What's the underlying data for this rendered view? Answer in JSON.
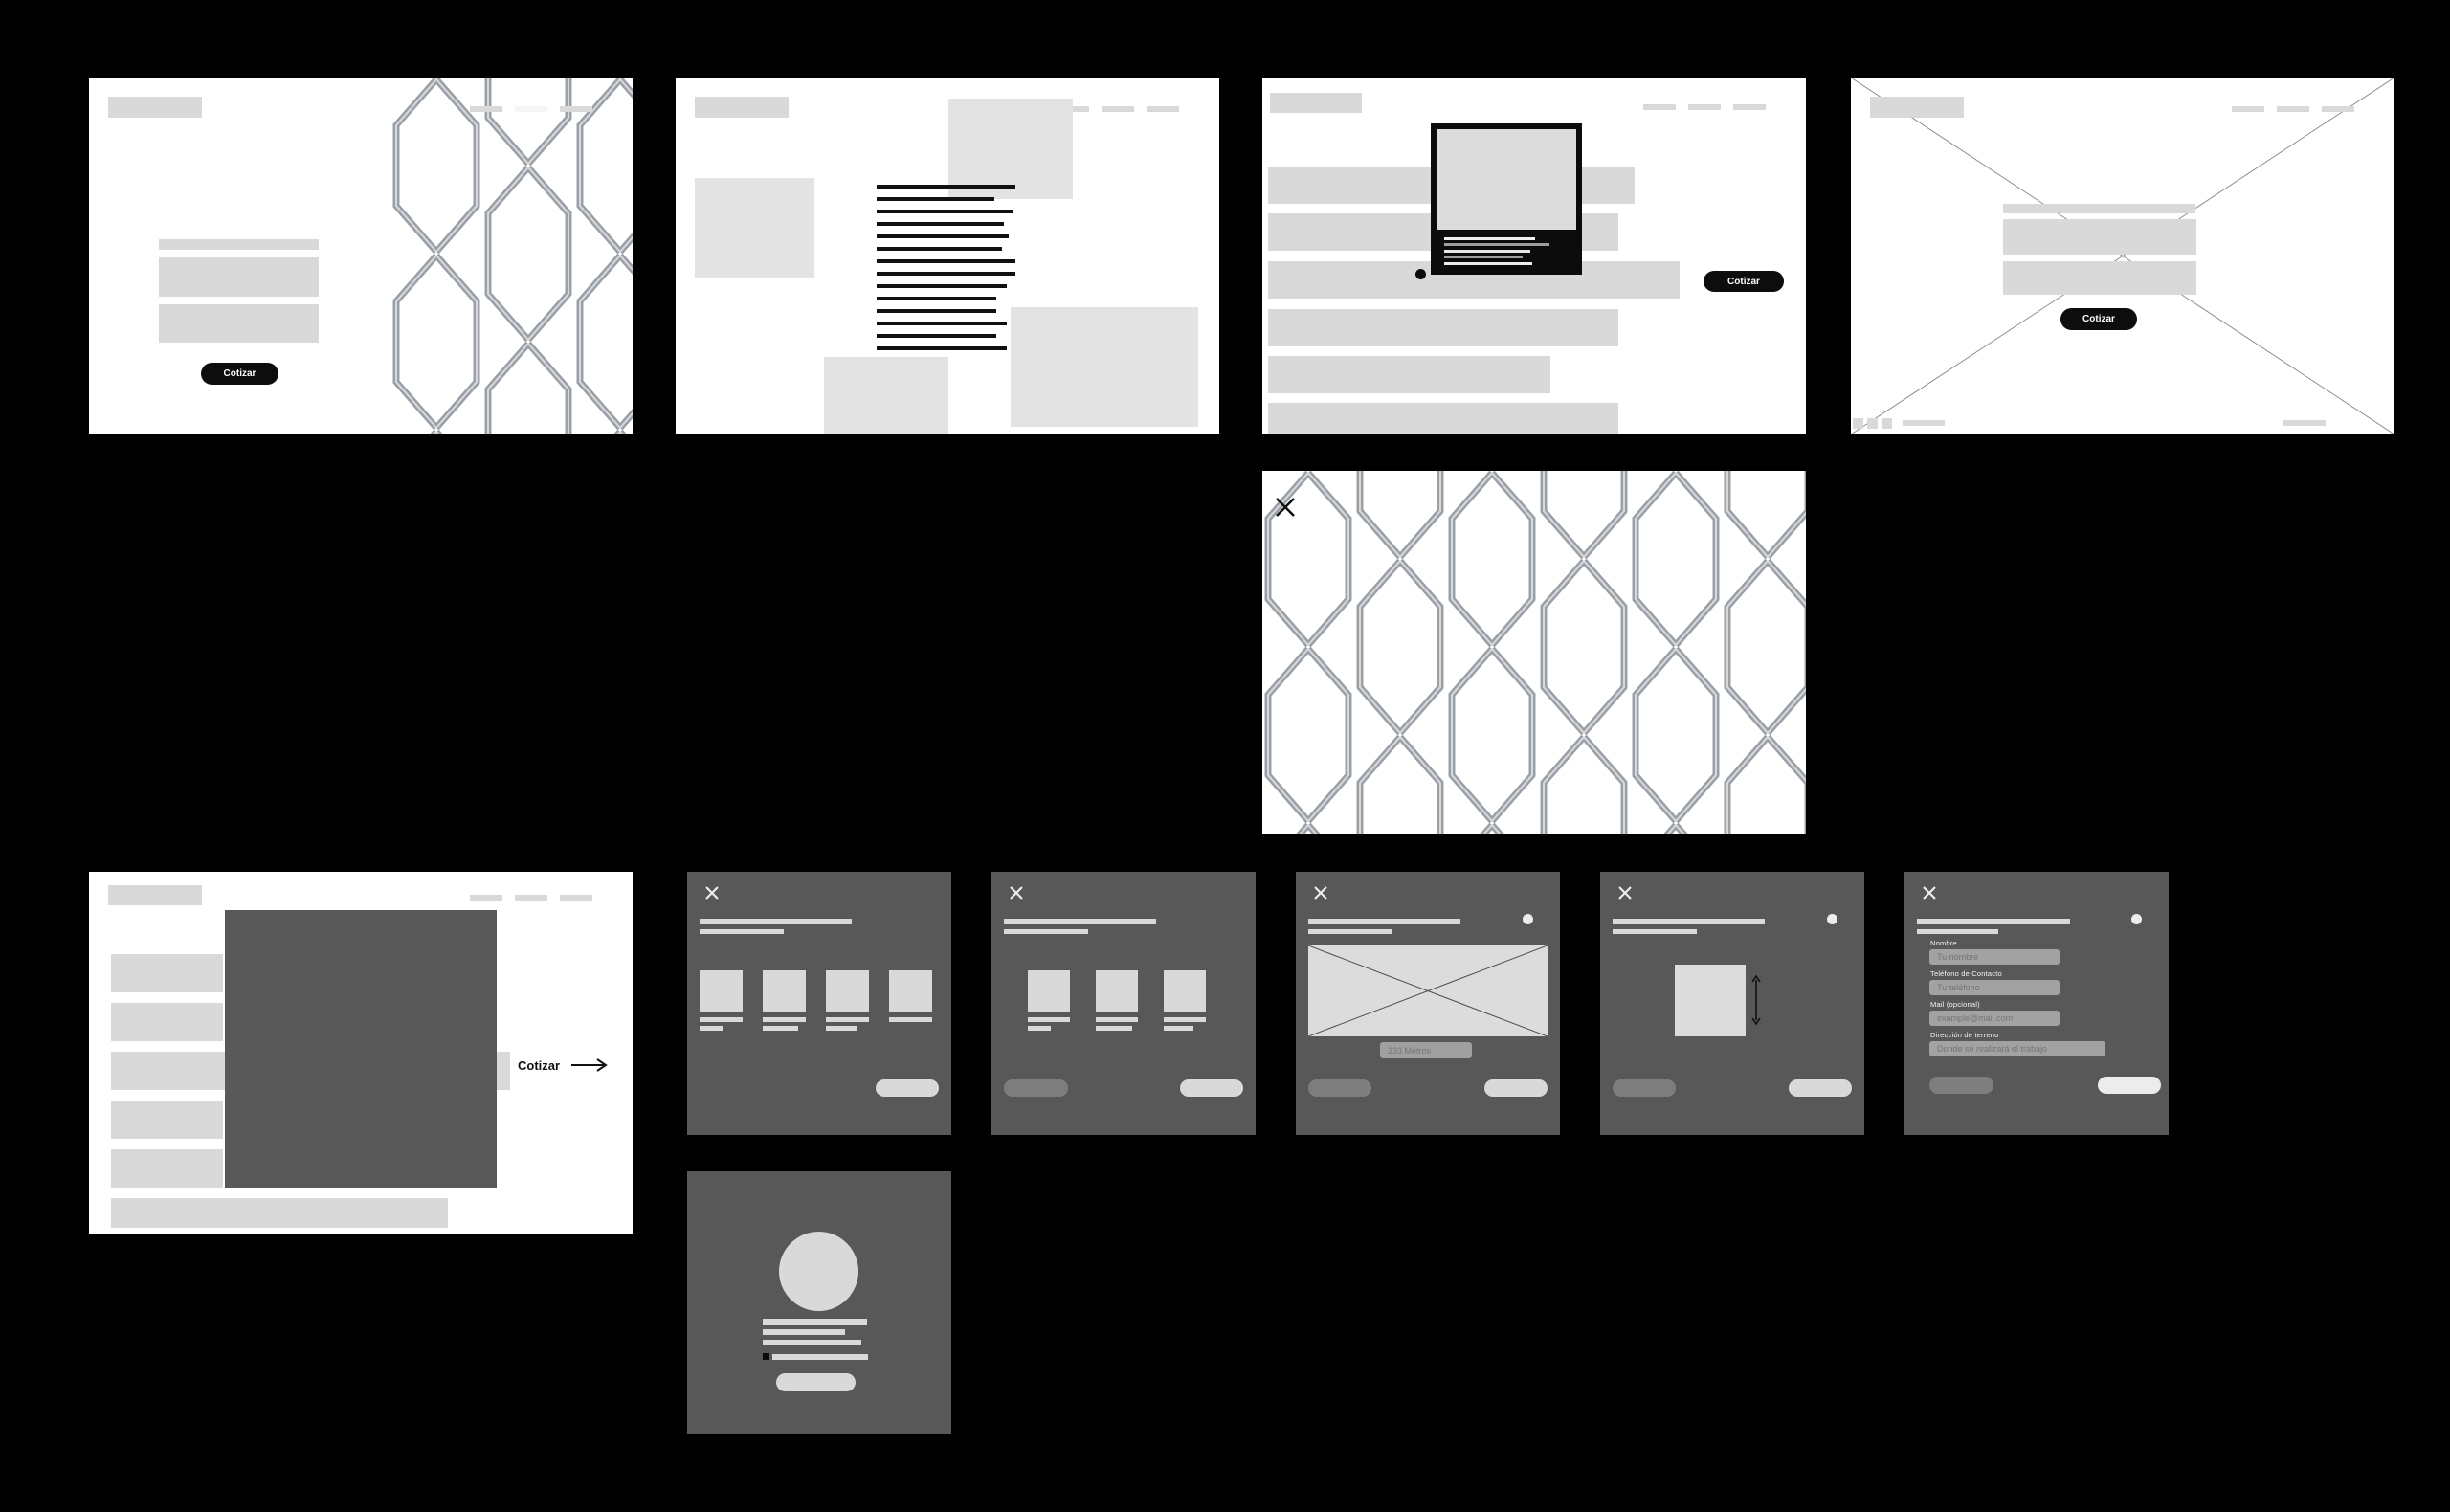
{
  "board": {
    "background": "#000000",
    "frame_bg": "#ffffff",
    "modal_bg": "#585858",
    "accent_black": "#0d0d0d",
    "placeholder_gray": "#d9d9d9"
  },
  "frames": {
    "hero": {
      "cta": "Cotizar"
    },
    "content": {},
    "product": {
      "cta": "Cotizar"
    },
    "placeholder": {
      "cta": "Cotizar"
    },
    "lightbox": {},
    "detail": {
      "cta_label": "Cotizar"
    }
  },
  "modals": {
    "options_four": {},
    "options_three": {},
    "measure": {
      "input_value": "333 Metros"
    },
    "height": {},
    "form": {
      "fields": [
        {
          "label": "Nombre",
          "placeholder": "Tu nombre"
        },
        {
          "label": "Teléfono de Contacto",
          "placeholder": "Tu teléfono"
        },
        {
          "label": "Mail (opcional)",
          "placeholder": "example@mail.com"
        },
        {
          "label": "Dirección de terreno",
          "placeholder": "Donde se realizará el trabajo"
        }
      ]
    },
    "confirmation": {}
  }
}
